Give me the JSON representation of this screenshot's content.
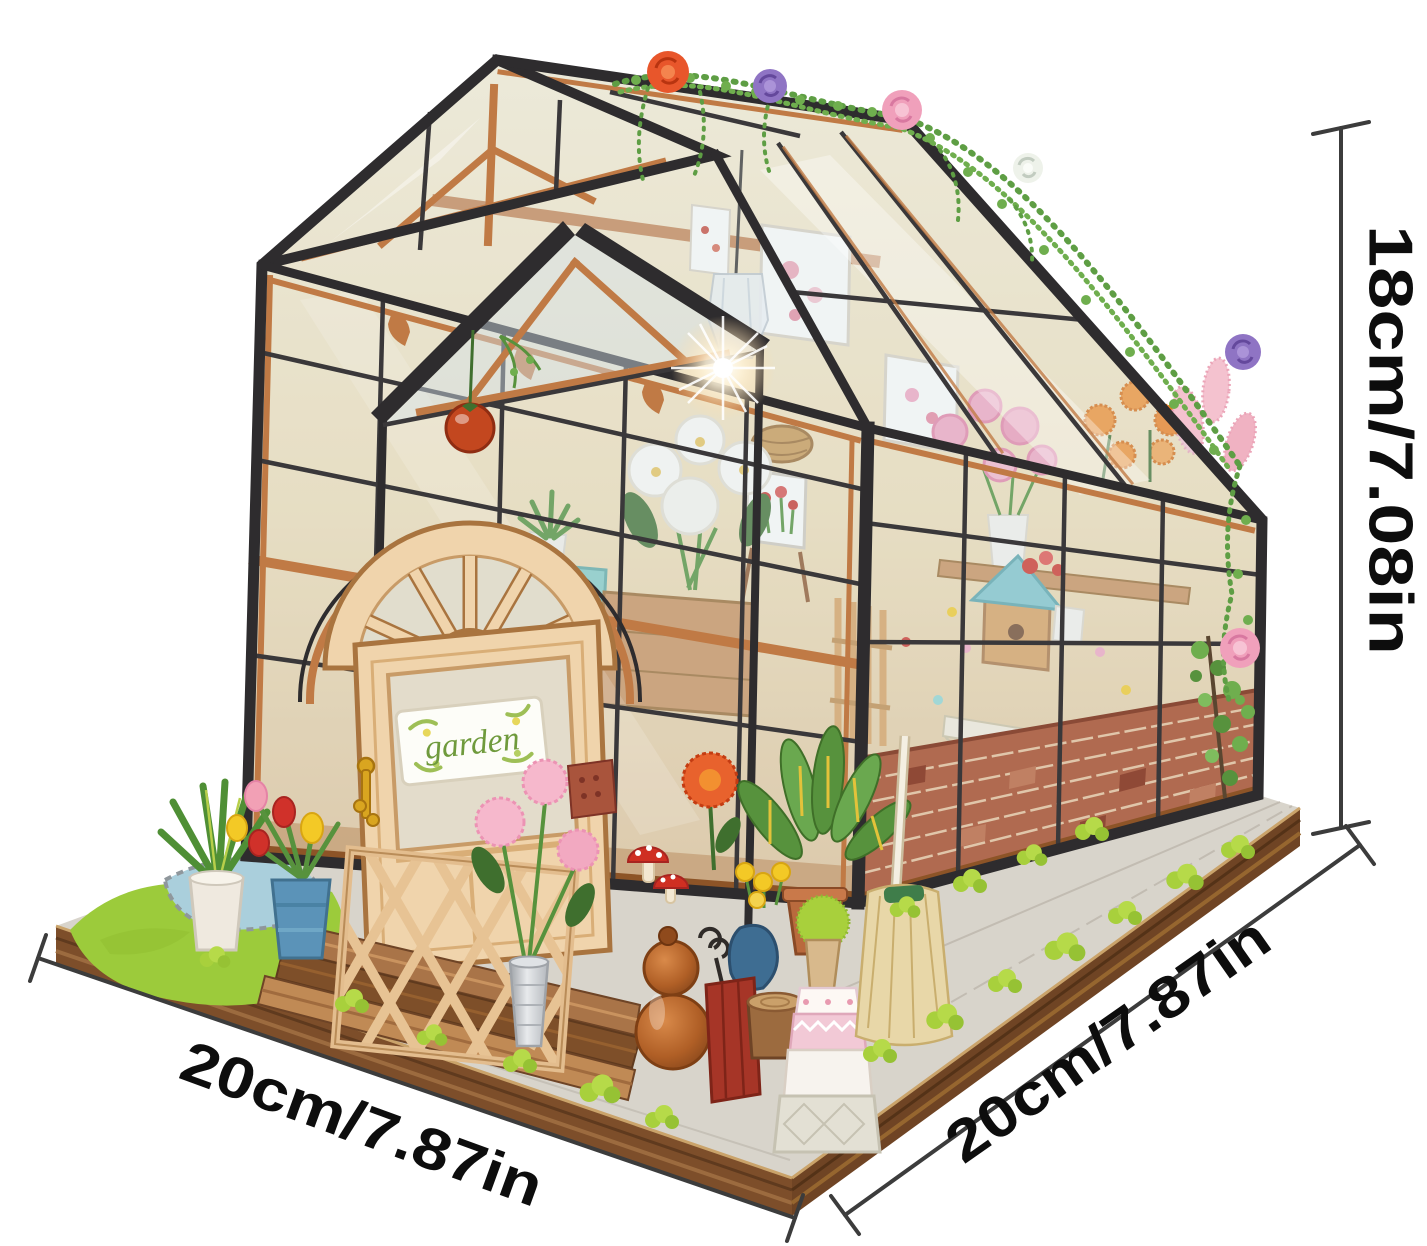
{
  "image": {
    "kind": "product-photo",
    "subject": "DIY miniature greenhouse flower-house dollhouse kit shown with size annotations",
    "background": "#ffffff"
  },
  "annotations": {
    "height_label": "18cm/7.08in",
    "base_left_label": "20cm/7.87in",
    "base_right_label": "20cm/7.87in"
  },
  "door_sign": {
    "text": "garden"
  },
  "palette": {
    "frame_black": "#2e2c2e",
    "wood_trim": "#c07a45",
    "door_wood": "#f0d4ac",
    "brick_red": "#b06a50",
    "grass_green": "#9ccb3b",
    "moss_green": "#a8d03c",
    "glass_tint": "#d0e0e8",
    "annotation_ink": "#0d0d0d"
  }
}
